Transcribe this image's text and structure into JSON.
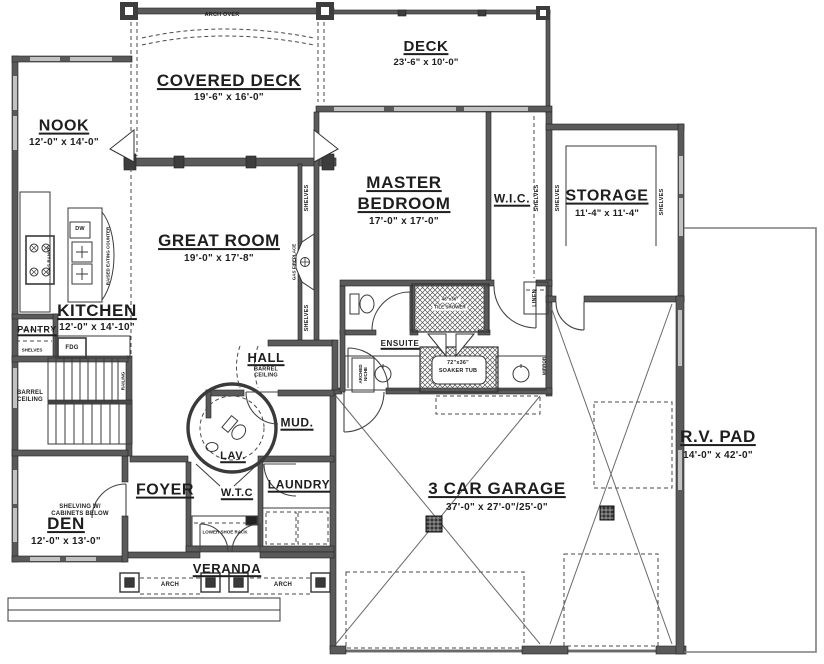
{
  "rooms": {
    "covered_deck": {
      "name": "COVERED DECK",
      "dims": "19'-6\" x 16'-0\""
    },
    "deck": {
      "name": "DECK",
      "dims": "23'-6\" x 10'-0\""
    },
    "nook": {
      "name": "NOOK",
      "dims": "12'-0\" x 14'-0\""
    },
    "great_room": {
      "name": "GREAT ROOM",
      "dims": "19'-0\" x 17'-8\""
    },
    "master_bedroom": {
      "name_line1": "MASTER",
      "name_line2": "BEDROOM",
      "dims": "17'-0\" x 17'-0\""
    },
    "wic": {
      "name": "W.I.C."
    },
    "storage": {
      "name": "STORAGE",
      "dims": "11'-4\" x 11'-4\""
    },
    "kitchen": {
      "name": "KITCHEN",
      "dims": "12'-0\" x 14'-10\""
    },
    "pantry": {
      "name": "PANTRY"
    },
    "ensuite": {
      "name": "ENSUITE"
    },
    "hall": {
      "name": "HALL"
    },
    "lav": {
      "name": "LAV."
    },
    "mud": {
      "name": "MUD."
    },
    "laundry": {
      "name": "LAUNDRY"
    },
    "wtc": {
      "name": "W.T.C"
    },
    "foyer": {
      "name": "FOYER"
    },
    "den": {
      "name": "DEN",
      "dims": "12'-0\" x 13'-0\""
    },
    "veranda": {
      "name": "VERANDA"
    },
    "garage": {
      "name": "3 CAR GARAGE",
      "dims": "37'-0\" x 27'-0\"/25'-0\""
    },
    "rv_pad": {
      "name": "R.V. PAD",
      "dims": "14'-0\" x 42'-0\""
    }
  },
  "annotations": {
    "arch_over": "ARCH OVER",
    "arch": "ARCH",
    "shelves": "SHELVES",
    "linen": "LINEN",
    "mirror": "MIRROR",
    "railing": "RAILING",
    "barrel_line1": "BARREL",
    "barrel_line2": "CEILING",
    "shelving_line1": "SHELVING W/",
    "shelving_line2": "CABINETS BELOW",
    "lower_shoe_rack": "LOWER SHOE RACK",
    "soaker_tub_dims": "72\"x36\"",
    "soaker_tub": "SOAKER TUB",
    "tile_shower_dims": "48\"x36\"",
    "tile_shower": "TILE SHOWER",
    "arched_niche_line1": "ARCHED",
    "arched_niche_line2": "NICHE",
    "gas_fireplace": "GAS FIREPLACE",
    "raised_eating_counter": "RAISED EATING COUNTER",
    "gas_range": "GAS RANGE",
    "dw": "DW",
    "fdg": "FDG"
  },
  "colors": {
    "ink": "#2b2b2b",
    "wall": "#5a5a5a",
    "window": "#c2c2c2",
    "background": "#ffffff"
  }
}
